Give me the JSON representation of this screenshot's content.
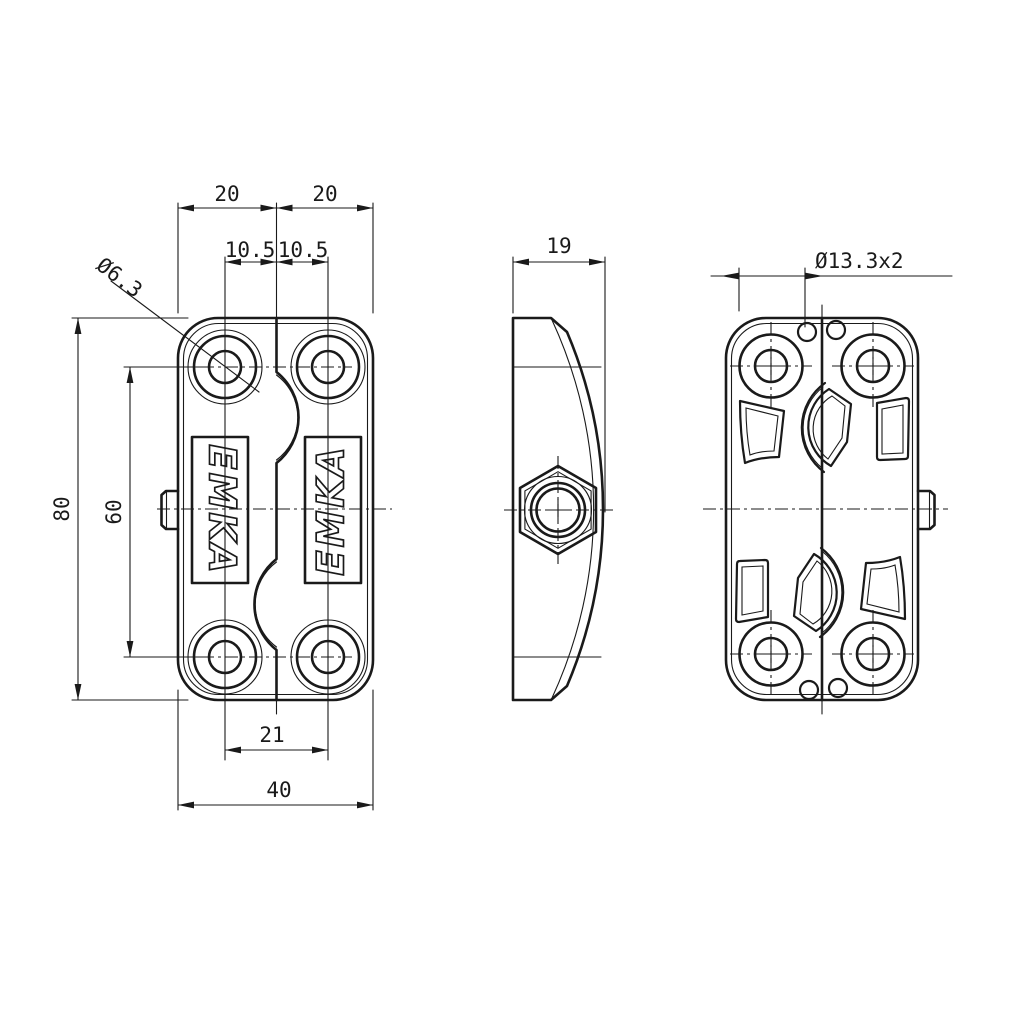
{
  "colors": {
    "line": "#1a1a1a",
    "background": "#ffffff"
  },
  "logo": {
    "text": "EMKA"
  },
  "dimensions": {
    "top_width_left": "20",
    "top_width_right": "20",
    "hole_offset_left": "10.5",
    "hole_offset_right": "10.5",
    "hole_diameter": "Ø6.3",
    "overall_height": "80",
    "hole_spacing_vertical": "60",
    "hole_spacing_horizontal": "21",
    "overall_width": "40",
    "depth": "19",
    "counterbore": "Ø13.3x2"
  }
}
